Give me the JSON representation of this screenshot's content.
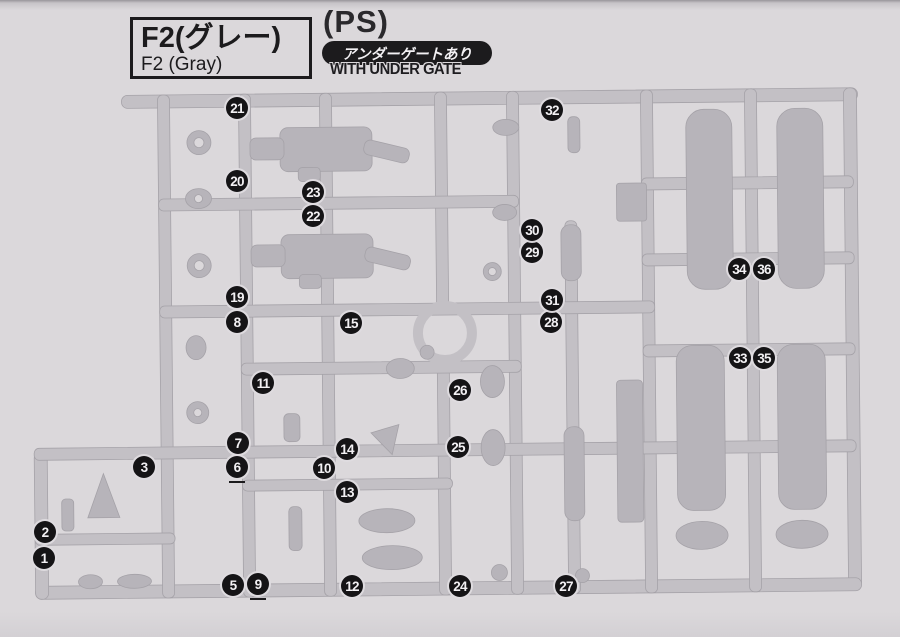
{
  "colors": {
    "paper": "#dbd8db",
    "bar": "#c3c0c5",
    "part": "#b7b4ba",
    "ink": "#1c1b1d",
    "badge_bg": "#151416",
    "badge_fg": "#f2f0f3"
  },
  "header": {
    "runner_code_jp": "F2(グレー)",
    "runner_code_en": "F2 (Gray)",
    "material": "(PS)",
    "undergate_jp": "アンダーゲートあり",
    "undergate_en": "WITH UNDER GATE"
  },
  "runner": {
    "callouts": [
      {
        "n": "1",
        "x": 44,
        "y": 558
      },
      {
        "n": "2",
        "x": 45,
        "y": 532
      },
      {
        "n": "3",
        "x": 144,
        "y": 467
      },
      {
        "n": "5",
        "x": 233,
        "y": 585
      },
      {
        "n": "6",
        "x": 237,
        "y": 467,
        "underline": true
      },
      {
        "n": "7",
        "x": 238,
        "y": 443
      },
      {
        "n": "8",
        "x": 237,
        "y": 322
      },
      {
        "n": "9",
        "x": 258,
        "y": 584,
        "underline": true
      },
      {
        "n": "10",
        "x": 324,
        "y": 468
      },
      {
        "n": "11",
        "x": 263,
        "y": 383
      },
      {
        "n": "12",
        "x": 352,
        "y": 586
      },
      {
        "n": "13",
        "x": 347,
        "y": 492
      },
      {
        "n": "14",
        "x": 347,
        "y": 449
      },
      {
        "n": "15",
        "x": 351,
        "y": 323
      },
      {
        "n": "19",
        "x": 237,
        "y": 297
      },
      {
        "n": "20",
        "x": 237,
        "y": 181
      },
      {
        "n": "21",
        "x": 237,
        "y": 108
      },
      {
        "n": "22",
        "x": 313,
        "y": 216
      },
      {
        "n": "23",
        "x": 313,
        "y": 192
      },
      {
        "n": "24",
        "x": 460,
        "y": 586
      },
      {
        "n": "25",
        "x": 458,
        "y": 447
      },
      {
        "n": "26",
        "x": 460,
        "y": 390
      },
      {
        "n": "27",
        "x": 566,
        "y": 586
      },
      {
        "n": "28",
        "x": 551,
        "y": 322
      },
      {
        "n": "29",
        "x": 532,
        "y": 252
      },
      {
        "n": "30",
        "x": 532,
        "y": 230
      },
      {
        "n": "31",
        "x": 552,
        "y": 300
      },
      {
        "n": "32",
        "x": 552,
        "y": 110
      },
      {
        "n": "33",
        "x": 740,
        "y": 358
      },
      {
        "n": "34",
        "x": 739,
        "y": 269
      },
      {
        "n": "35",
        "x": 764,
        "y": 358
      },
      {
        "n": "36",
        "x": 764,
        "y": 269
      }
    ]
  }
}
